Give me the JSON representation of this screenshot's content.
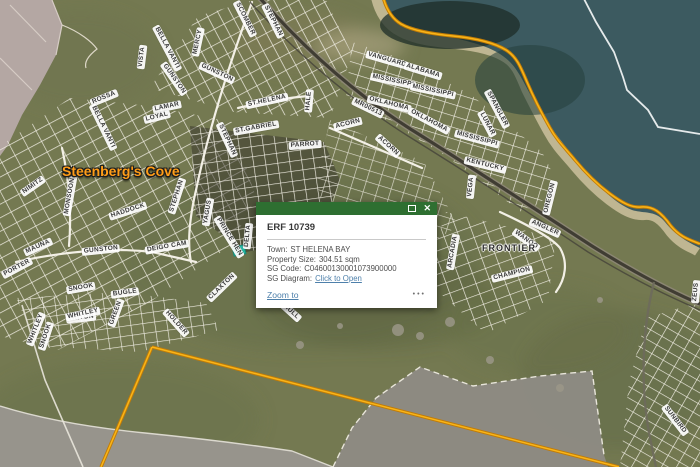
{
  "app": {
    "description": "GIS parcel viewer with satellite imagery and cadastral overlay"
  },
  "popup": {
    "title": "ERF 10739",
    "fields": [
      {
        "label": "Town:",
        "value": "ST HELENA BAY"
      },
      {
        "label": "Property Size:",
        "value": "304.51 sqm"
      },
      {
        "label": "SG Code:",
        "value": "C04600130001073900000"
      },
      {
        "label": "SG Diagram:",
        "value": "Click to Open",
        "is_link": true
      }
    ],
    "town_label": "Town:",
    "town_value": "ST HELENA BAY",
    "size_label": "Property Size:",
    "size_value": "304.51 sqm",
    "sg_code_label": "SG Code:",
    "sg_code_value": "C04600130001073900000",
    "sg_diagram_label": "SG Diagram:",
    "sg_diagram_link": "Click to Open",
    "zoom_to_label": "Zoom to",
    "more_options_glyph": "•••",
    "close_glyph": "✕"
  },
  "map": {
    "place_labels": {
      "cove": "Steenberg's Cove",
      "frontier": "FRONTIER"
    },
    "street_labels": [
      {
        "text": "VISTA",
        "x": 142,
        "y": 57,
        "rot": -83
      },
      {
        "text": "BELLA VANTI",
        "x": 167,
        "y": 48,
        "rot": 62
      },
      {
        "text": "MERCY",
        "x": 198,
        "y": 42,
        "rot": -78
      },
      {
        "text": "GUNSTON",
        "x": 174,
        "y": 79,
        "rot": 55
      },
      {
        "text": "GUNSTON",
        "x": 217,
        "y": 73,
        "rot": 25
      },
      {
        "text": "ROSSA",
        "x": 104,
        "y": 98,
        "rot": -22
      },
      {
        "text": "LAMAR",
        "x": 167,
        "y": 107,
        "rot": -12
      },
      {
        "text": "LOYAL",
        "x": 157,
        "y": 117,
        "rot": -14
      },
      {
        "text": "BELLA VANTI",
        "x": 103,
        "y": 127,
        "rot": 64
      },
      {
        "text": "SCOMBER",
        "x": 245,
        "y": 19,
        "rot": 63
      },
      {
        "text": "STEPHAN",
        "x": 273,
        "y": 21,
        "rot": 63
      },
      {
        "text": "STEPHAN",
        "x": 227,
        "y": 140,
        "rot": 65
      },
      {
        "text": "ST.HELENA",
        "x": 267,
        "y": 101,
        "rot": -12
      },
      {
        "text": "HALE",
        "x": 309,
        "y": 101,
        "rot": -85
      },
      {
        "text": "ST.GABRIEL",
        "x": 256,
        "y": 128,
        "rot": -10
      },
      {
        "text": "PARROT",
        "x": 305,
        "y": 145,
        "rot": -4
      },
      {
        "text": "ACORN",
        "x": 348,
        "y": 124,
        "rot": -14
      },
      {
        "text": "ACORN",
        "x": 388,
        "y": 146,
        "rot": 42
      },
      {
        "text": "MR00513",
        "x": 368,
        "y": 108,
        "rot": 26
      },
      {
        "text": "VANGUARD",
        "x": 387,
        "y": 60,
        "rot": 16
      },
      {
        "text": "ALABAMA",
        "x": 423,
        "y": 71,
        "rot": 17
      },
      {
        "text": "MISSISSIPPI",
        "x": 393,
        "y": 81,
        "rot": 12
      },
      {
        "text": "MISSISSIPPI",
        "x": 433,
        "y": 91,
        "rot": 12
      },
      {
        "text": "OKLAHOMA",
        "x": 389,
        "y": 104,
        "rot": 14
      },
      {
        "text": "OKLAHOMA",
        "x": 429,
        "y": 121,
        "rot": 28
      },
      {
        "text": "SPANGLER",
        "x": 497,
        "y": 109,
        "rot": 62
      },
      {
        "text": "LUNAR",
        "x": 487,
        "y": 124,
        "rot": 62
      },
      {
        "text": "MISSISSIPPI",
        "x": 477,
        "y": 139,
        "rot": 15
      },
      {
        "text": "KENTUCKY",
        "x": 485,
        "y": 165,
        "rot": 14
      },
      {
        "text": "VEGA",
        "x": 471,
        "y": 187,
        "rot": -84
      },
      {
        "text": "OREGON",
        "x": 550,
        "y": 198,
        "rot": -76
      },
      {
        "text": "ANGLER",
        "x": 545,
        "y": 228,
        "rot": 24
      },
      {
        "text": "WANOO",
        "x": 526,
        "y": 240,
        "rot": 36
      },
      {
        "text": "CHAMPION",
        "x": 512,
        "y": 274,
        "rot": -14
      },
      {
        "text": "ARCADIA",
        "x": 453,
        "y": 252,
        "rot": -80
      },
      {
        "text": "NIMITZ",
        "x": 33,
        "y": 186,
        "rot": -35
      },
      {
        "text": "MONSOON",
        "x": 70,
        "y": 196,
        "rot": -80
      },
      {
        "text": "HADDOCK",
        "x": 128,
        "y": 211,
        "rot": -18
      },
      {
        "text": "STEPHAN",
        "x": 177,
        "y": 196,
        "rot": -72
      },
      {
        "text": "YAGUS",
        "x": 208,
        "y": 212,
        "rot": -80
      },
      {
        "text": "MAUNA",
        "x": 38,
        "y": 247,
        "rot": -24
      },
      {
        "text": "PORTER",
        "x": 17,
        "y": 268,
        "rot": -28
      },
      {
        "text": "GUNSTON",
        "x": 101,
        "y": 250,
        "rot": -6
      },
      {
        "text": "DEIGO CAM",
        "x": 167,
        "y": 247,
        "rot": -10
      },
      {
        "text": "PRINCE HEN",
        "x": 229,
        "y": 237,
        "rot": 58
      },
      {
        "text": "DELTA",
        "x": 248,
        "y": 236,
        "rot": -84
      },
      {
        "text": "SNOOK",
        "x": 81,
        "y": 288,
        "rot": -10
      },
      {
        "text": "BUGLE",
        "x": 125,
        "y": 293,
        "rot": -8
      },
      {
        "text": "TRITON",
        "x": 81,
        "y": 318,
        "rot": -6
      },
      {
        "text": "SNOOK",
        "x": 46,
        "y": 336,
        "rot": -72
      },
      {
        "text": "WHITLEY",
        "x": 36,
        "y": 329,
        "rot": -68
      },
      {
        "text": "WHITLEY",
        "x": 83,
        "y": 314,
        "rot": -12
      },
      {
        "text": "GREEN",
        "x": 116,
        "y": 313,
        "rot": -70
      },
      {
        "text": "HOLDER",
        "x": 176,
        "y": 323,
        "rot": 48
      },
      {
        "text": "CLAXTON",
        "x": 222,
        "y": 287,
        "rot": -44
      },
      {
        "text": "HULL",
        "x": 291,
        "y": 312,
        "rot": 42
      },
      {
        "text": "ZEUS",
        "x": 696,
        "y": 292,
        "rot": -84
      },
      {
        "text": "SUNBIRD",
        "x": 675,
        "y": 420,
        "rot": 52
      }
    ],
    "colors": {
      "boundary_orange": "#f9b519",
      "selection_teal": "#20c0ad",
      "popup_header_green": "#2e6f31",
      "link_blue": "#4e80ab",
      "water": "#3c5a60",
      "place_label_orange": "#ff9d18"
    }
  }
}
